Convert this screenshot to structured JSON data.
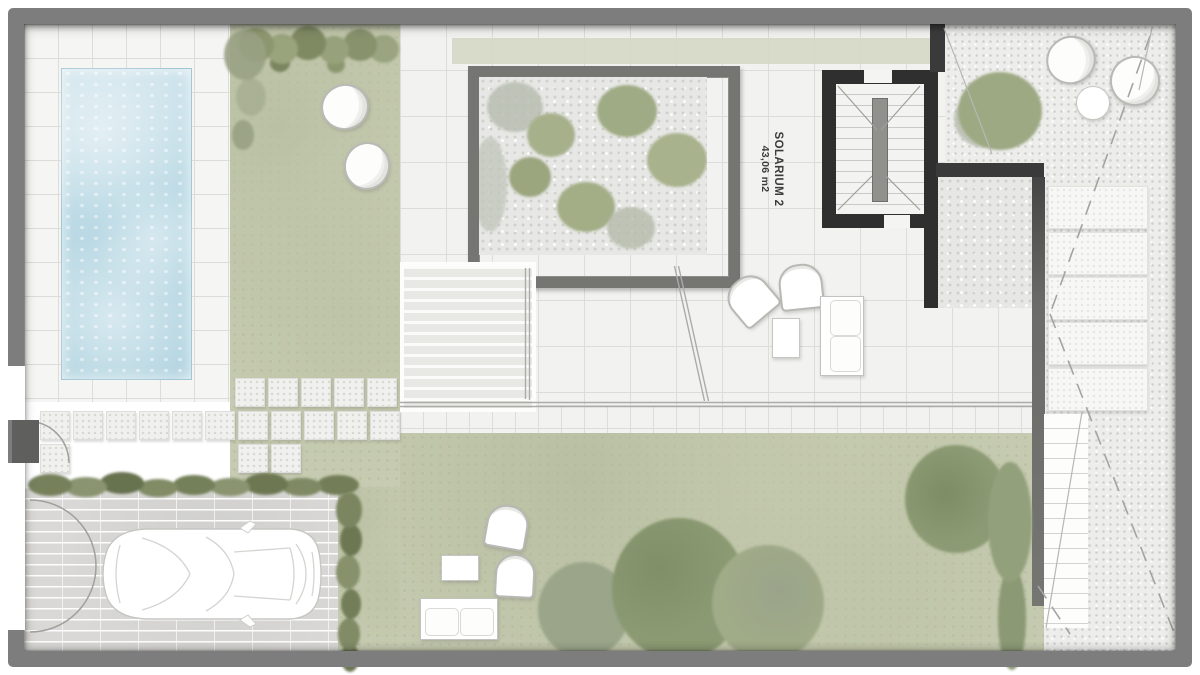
{
  "plan": {
    "solarium": {
      "label": "SOLARIUM 2",
      "area": "43,06 m2"
    }
  },
  "colors": {
    "frame": "#7d7d7d",
    "lawn": "#c6cbb1",
    "pool_water": "#bcdae5",
    "tile_light": "#f2f2f0",
    "tile_line": "#dcdcd8",
    "gravel": "#ededeb",
    "wall_dark": "#2f2f2f",
    "wall_gray": "#606060",
    "hedge_dark": "#77825c",
    "tree_green": "#8e9c74",
    "brick": "#d9d8d6",
    "label_text": "#3c3c3c"
  }
}
